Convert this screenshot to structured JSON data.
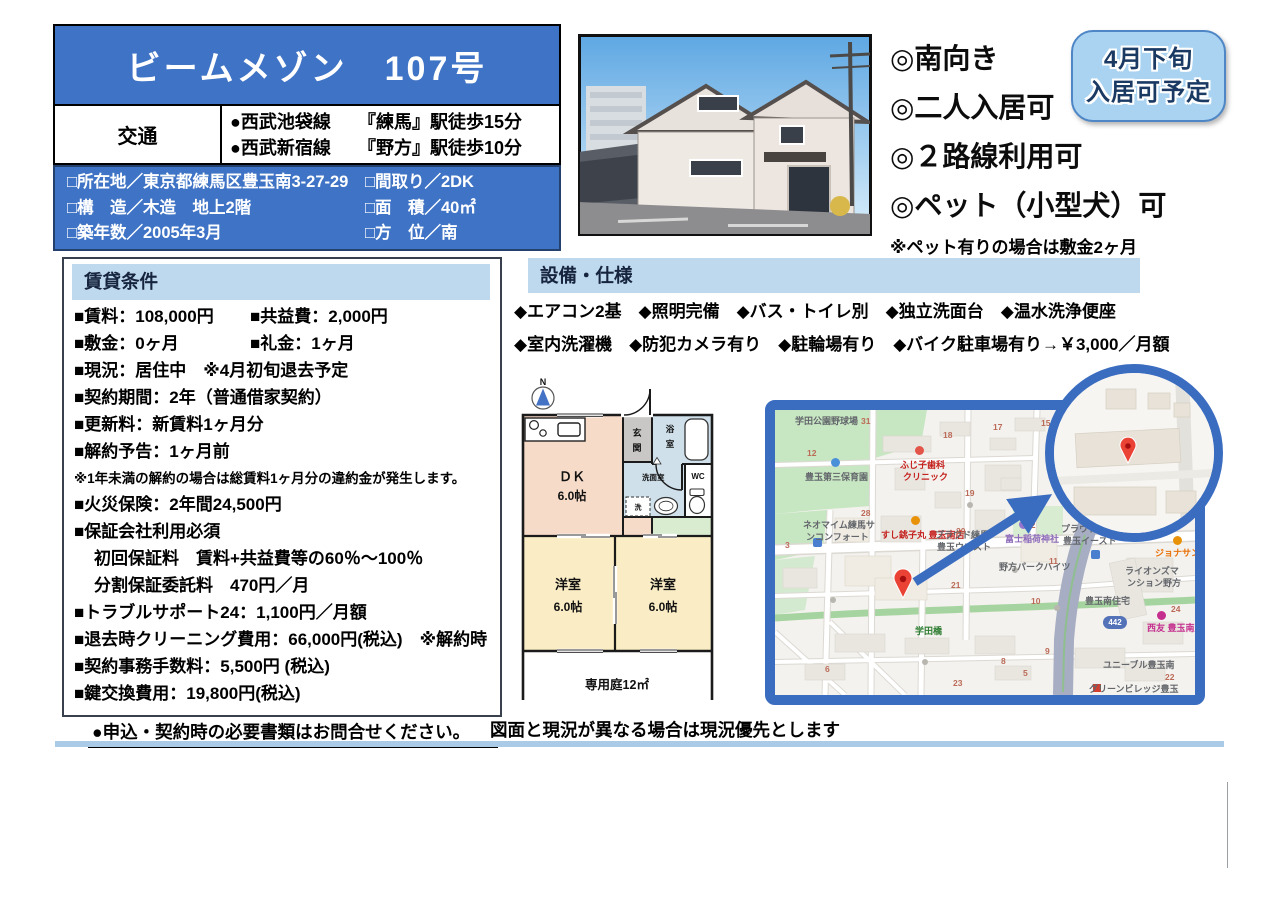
{
  "header": {
    "title": "ビームメゾン　107号",
    "access_label": "交通",
    "access": [
      {
        "line": "●西武池袋線",
        "station": "『練馬』駅徒歩15分"
      },
      {
        "line": "●西武新宿線",
        "station": "『野方』駅徒歩10分"
      }
    ],
    "details": {
      "col1": [
        "□所在地／東京都練馬区豊玉南3-27-29",
        "□構　造／木造　地上2階",
        "□築年数／2005年3月"
      ],
      "col2": [
        "□間取り／2DK",
        "□面　積／40㎡",
        "□方　位／南"
      ]
    }
  },
  "features": {
    "items": [
      "◎南向き",
      "◎二人入居可",
      "◎２路線利用可",
      "◎ペット（小型犬）可"
    ],
    "note": "※ペット有りの場合は敷金2ヶ月"
  },
  "badge": {
    "line1": "4月下旬",
    "line2": "入居可予定"
  },
  "rental": {
    "header": "賃貸条件",
    "rows": [
      {
        "a": "■賃料：108,000円",
        "b": "■共益費：2,000円"
      },
      {
        "a": "■敷金：0ヶ月",
        "b": "■礼金：1ヶ月"
      },
      {
        "a": "■現況：居住中　※4月初旬退去予定"
      },
      {
        "a": "■契約期間：2年（普通借家契約）"
      },
      {
        "a": "■更新料：新賃料1ヶ月分"
      },
      {
        "a": "■解約予告：1ヶ月前"
      },
      {
        "a": "※1年未満の解約の場合は総賃料1ヶ月分の違約金が発生します。"
      },
      {
        "a": "■火災保険：2年間24,500円"
      },
      {
        "a": "■保証会社利用必須"
      },
      {
        "a": "初回保証料　賃料+共益費等の60％～100％"
      },
      {
        "a": "分割保証委託料　470円／月"
      },
      {
        "a": "■トラブルサポート24：1,100円／月額"
      },
      {
        "a": "■退去時クリーニング費用：66,000円(税込)　※解約時"
      },
      {
        "a": "■契約事務手数料：5,500円 (税込)"
      },
      {
        "a": "■鍵交換費用：19,800円(税込)"
      }
    ]
  },
  "equipment": {
    "header": "設備・仕様",
    "line1": "◆エアコン2基　◆照明完備　◆バス・トイレ別　◆独立洗面台　◆温水洗浄便座",
    "line2": "◆室内洗濯機　◆防犯カメラ有り　◆駐輪場有り　◆バイク駐車場有り→￥3,000／月額"
  },
  "floorplan": {
    "north": "N",
    "dk": "ＤＫ",
    "dk_size": "6.0帖",
    "entrance1": "玄",
    "entrance2": "関",
    "bath1": "浴",
    "bath2": "室",
    "washroom": "洗面室",
    "washer": "洗",
    "wc": "WC",
    "west": "洋室",
    "west_size": "6.0帖",
    "garden": "専用庭12㎡"
  },
  "map": {
    "labels": [
      "学田公園野球場",
      "豊玉第三保育園",
      "ふじ子歯科",
      "クリニック",
      "ネオマイム練馬サ",
      "ンコンフォート",
      "すし銚子丸 豊玉南店",
      "プラウド練馬",
      "豊玉ウエスト",
      "富士稲荷神社",
      "プラウド練馬",
      "豊玉イースト",
      "野方パークハイツ",
      "ジョナサン",
      "ライオンズマ",
      "ンション野方",
      "豊玉南住宅",
      "西友 豊玉南店",
      "ユニーブル豊玉南",
      "グリーンビレッジ豊玉",
      "学田橋"
    ],
    "numbers": [
      "31",
      "18",
      "17",
      "15",
      "12",
      "19",
      "28",
      "20",
      "12",
      "3",
      "11",
      "21",
      "10",
      "24",
      "9",
      "8",
      "23",
      "5",
      "22",
      "6"
    ],
    "route_badge": "442"
  },
  "notes": {
    "left": "●申込・契約時の必要書類はお問合せください。",
    "right": "図面と現況が異なる場合は現況優先とします"
  },
  "colors": {
    "main_blue": "#3f73c5",
    "band_blue": "#bed9ed",
    "badge_bg": "#a9d3f1",
    "badge_border": "#4e86c6",
    "badge_text": "#1a3a64",
    "map_border": "#3a6cc0",
    "pin_red": "#ea4335",
    "plan_dk": "#f7dbc9",
    "plan_rooms": "#faedc5",
    "plan_wet": "#cfe0eb",
    "plan_entry": "#c8c7c5",
    "plan_green": "#d9ecd0"
  }
}
